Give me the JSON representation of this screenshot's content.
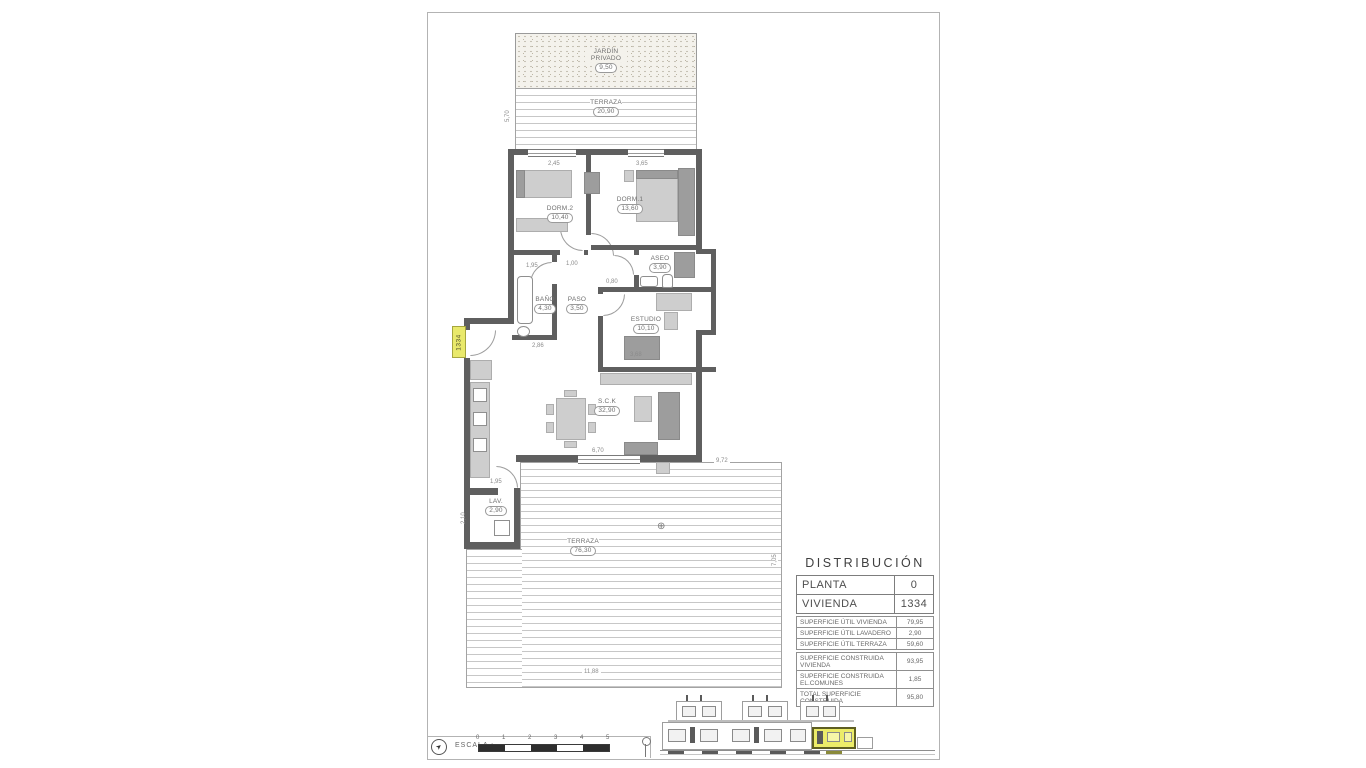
{
  "distribucion": {
    "title": "DISTRIBUCIÓN",
    "main_rows": [
      {
        "label": "PLANTA",
        "value": "0"
      },
      {
        "label": "VIVIENDA",
        "value": "1334"
      }
    ],
    "util_rows": [
      {
        "label": "SUPERFICIE ÚTIL VIVIENDA",
        "value": "79,95"
      },
      {
        "label": "SUPERFICIE ÚTIL LAVADERO",
        "value": "2,90"
      },
      {
        "label": "SUPERFICIE ÚTIL TERRAZA",
        "value": "59,60"
      }
    ],
    "construida_rows": [
      {
        "label": "SUPERFICIE CONSTRUIDA VIVIENDA",
        "value": "93,95"
      },
      {
        "label": "SUPERFICIE CONSTRUIDA EL.COMUNES",
        "value": "1,85"
      },
      {
        "label": "TOTAL SUPERFICIE CONSTRUIDA",
        "value": "95,80"
      }
    ]
  },
  "plan": {
    "unit_tag": "1334",
    "rooms": {
      "jardin": {
        "name": "JARDÍN PRIVADO",
        "area": "9,50"
      },
      "terraza_top": {
        "name": "TERRAZA",
        "area": "20,90"
      },
      "dorm2": {
        "name": "DORM.2",
        "area": "10,40"
      },
      "dorm1": {
        "name": "DORM.1",
        "area": "13,60"
      },
      "aseo": {
        "name": "ASEO",
        "area": "3,90"
      },
      "bano": {
        "name": "BAÑO",
        "area": "4,30"
      },
      "paso": {
        "name": "PASO",
        "area": "3,50"
      },
      "estudio": {
        "name": "ESTUDIO",
        "area": "10,10"
      },
      "sck": {
        "name": "S.C.K",
        "area": "32,90"
      },
      "lav": {
        "name": "LAV.",
        "area": "2,90"
      },
      "terraza_main": {
        "name": "TERRAZA",
        "area": "76,30"
      }
    },
    "dims": {
      "d245": "2,45",
      "d365": "3,65",
      "d570": "5,70",
      "d100": "1,00",
      "d195a": "1,95",
      "d080": "0,80",
      "d286": "2,86",
      "d368": "3,68",
      "d670": "6,70",
      "d195b": "1,95",
      "d210": "2,10",
      "d1188": "11,88",
      "d972": "9,72",
      "d705": "7,05"
    },
    "drain_symbol": "⊕"
  },
  "footer": {
    "scale_label": "ESCALA :",
    "scale_ticks": [
      "0",
      "1",
      "2",
      "3",
      "4",
      "5"
    ],
    "north_glyph": "➤"
  }
}
